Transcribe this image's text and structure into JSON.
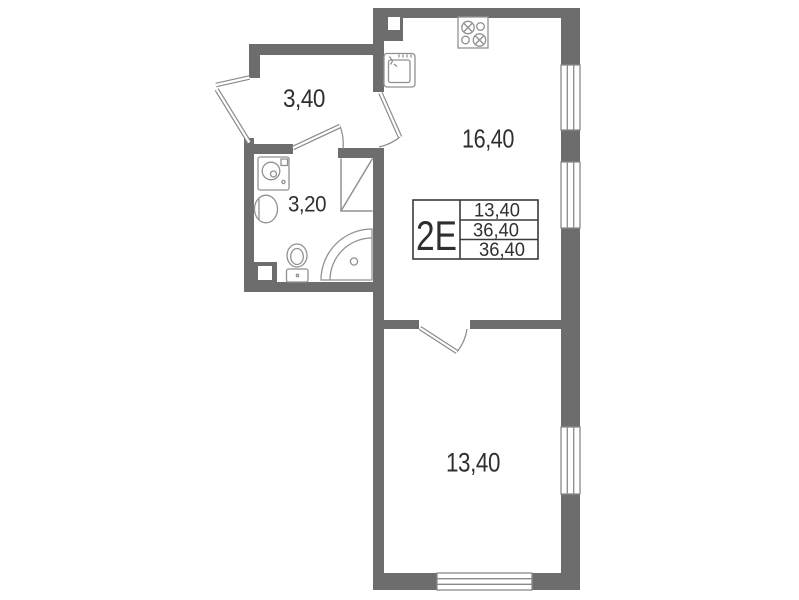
{
  "plan": {
    "unit": {
      "code": "2E"
    },
    "info_table": {
      "unit_label": "2E",
      "rows": [
        "13,40",
        "36,40",
        "36,40"
      ]
    },
    "rooms": {
      "hallway": {
        "area": "3,40"
      },
      "bathroom": {
        "area": "3,20"
      },
      "kitchen_living": {
        "area": "16,40"
      },
      "bedroom": {
        "area": "13,40"
      }
    },
    "colors": {
      "wall": "#6d6d6d",
      "fixture_line": "#919191",
      "window_line": "#8a8a8a",
      "door_line": "#8a8a8a",
      "table_line": "#3a3a3a",
      "text": "#2f2f2f",
      "background": "#ffffff"
    }
  }
}
